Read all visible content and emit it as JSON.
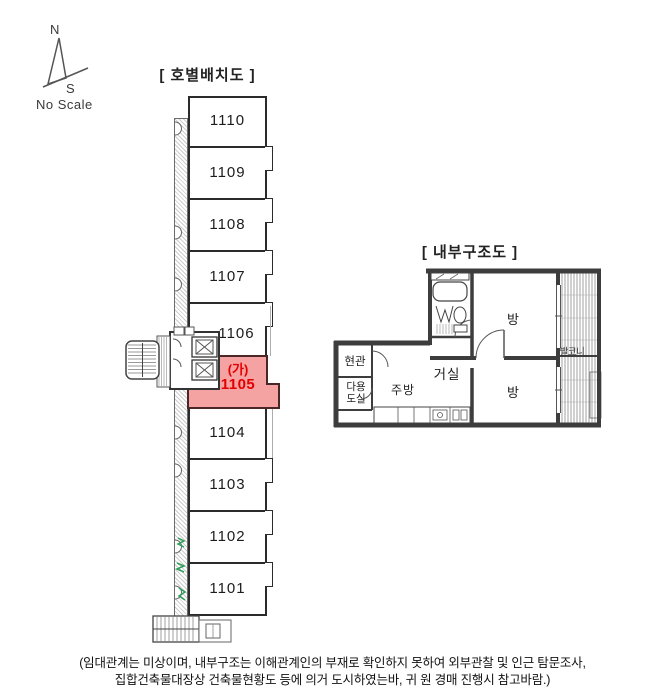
{
  "compass": {
    "north_label": "N",
    "south_label": "S",
    "scale_label": "No Scale"
  },
  "unit_layout": {
    "title": "[ 호별배치도 ]",
    "units": [
      {
        "label": "1110",
        "highlighted": false
      },
      {
        "label": "1109",
        "highlighted": false
      },
      {
        "label": "1108",
        "highlighted": false
      },
      {
        "label": "1107",
        "highlighted": false
      },
      {
        "label": "1106",
        "highlighted": false
      },
      {
        "label": "1105",
        "prefix": "(가)",
        "highlighted": true
      },
      {
        "label": "1104",
        "highlighted": false
      },
      {
        "label": "1103",
        "highlighted": false
      },
      {
        "label": "1102",
        "highlighted": false
      },
      {
        "label": "1101",
        "highlighted": false
      }
    ]
  },
  "floor_plan": {
    "title": "[ 내부구조도 ]",
    "rooms": {
      "entrance": "현관",
      "utility_line1": "다용",
      "utility_line2": "도실",
      "kitchen": "주방",
      "living": "거실",
      "room_top": "방",
      "room_bottom": "방",
      "balcony": "발코니"
    }
  },
  "footer": {
    "line1": "(임대관계는 미상이며, 내부구조는 이해관계인의 부재로 확인하지 못하여 외부관찰 및 인근 탐문조사,",
    "line2": "집합건축물대장상 건축물현황도 등에 의거 도시하였는바, 귀 원 경매 진행시 참고바람.)"
  },
  "colors": {
    "highlight_fill": "#F5A2A2",
    "highlight_text": "#E30000",
    "wall": "#3d3d3d"
  }
}
